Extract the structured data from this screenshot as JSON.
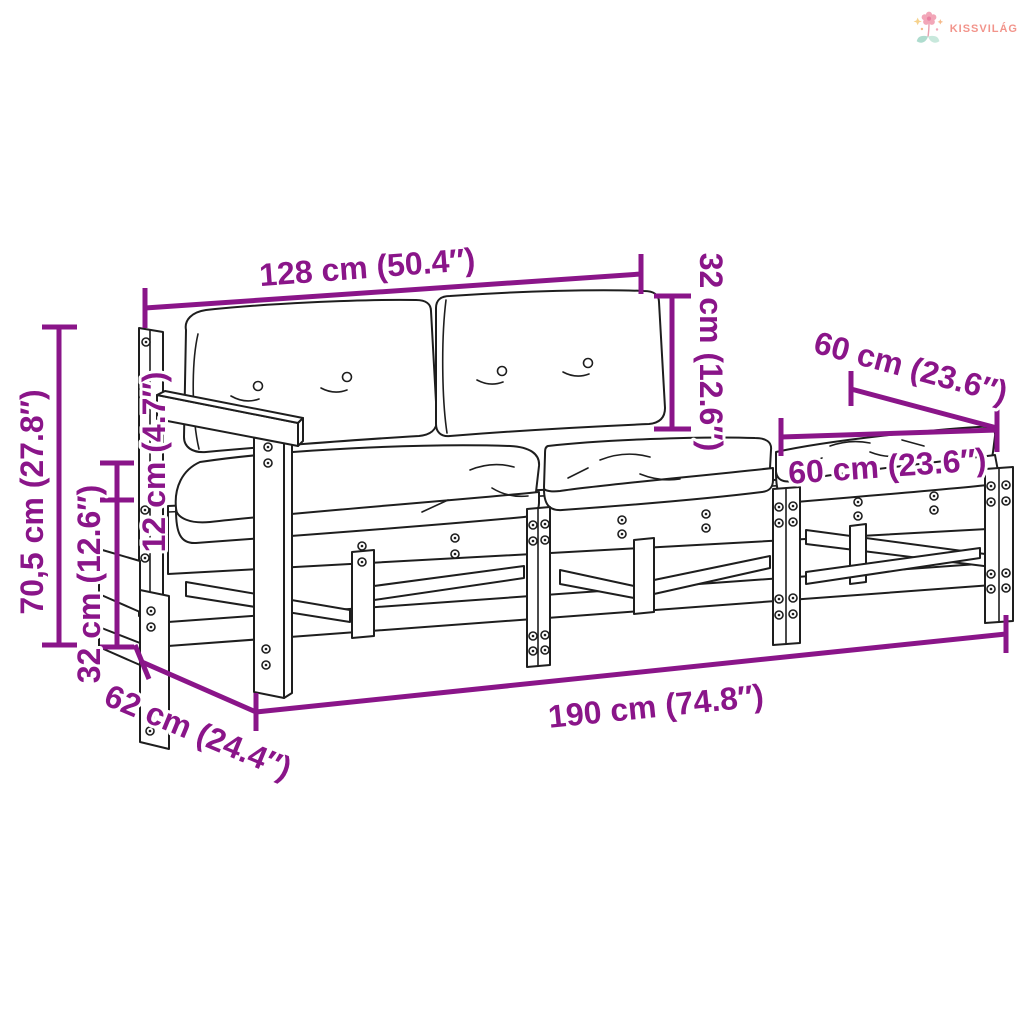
{
  "brand": {
    "name": "KISSVILÁG"
  },
  "dimensions": {
    "sofa_width": "128 cm (50.4″)",
    "back_cushion_height": "32 cm (12.6″)",
    "ottoman_depth": "60 cm (23.6″)",
    "ottoman_width": "60 cm (23.6″)",
    "total_height": "70,5 cm (27.8″)",
    "cushion_thickness": "12 cm (4.7″)",
    "frame_height": "32 cm (12.6″)",
    "depth": "62 cm (24.4″)",
    "total_length": "190 cm (74.8″)"
  },
  "colors": {
    "dimension_annotation": "#8A1589",
    "line_art": "#1E1E1E",
    "brand_text": "#F2948B",
    "flower_pink": "#F2A6B8",
    "leaf_teal": "#AEDCCE"
  }
}
